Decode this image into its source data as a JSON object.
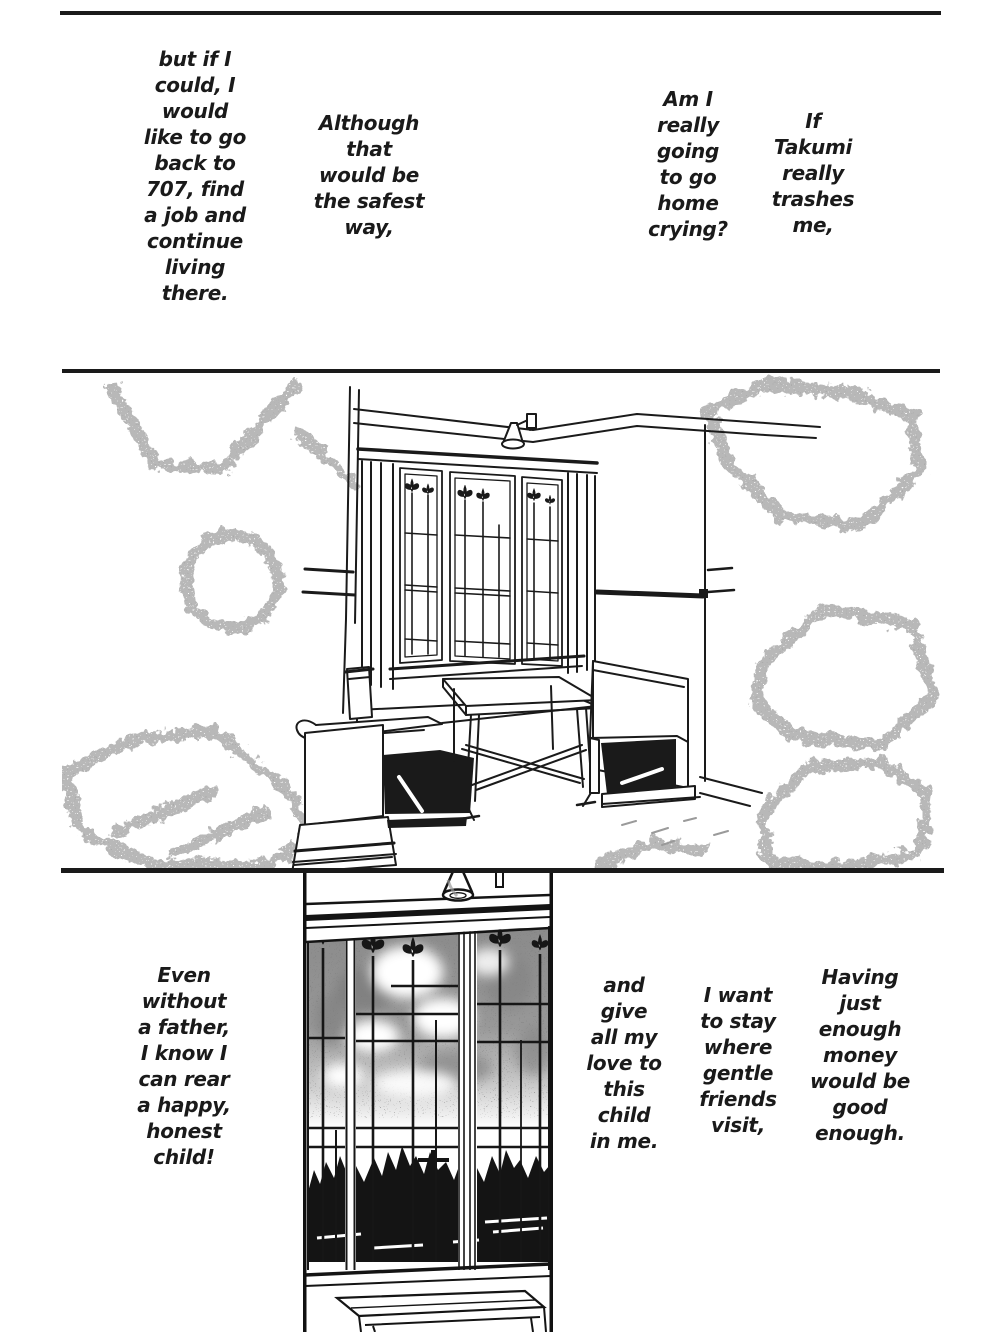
{
  "page": {
    "bg": "#ffffff",
    "ink": "#1a1a1a",
    "tone_gray": "#9a9a9a"
  },
  "thoughts": {
    "t1": {
      "text": "but if I\ncould, I\nwould\nlike to go\nback to\n707, find\na job and\ncontinue\nliving\nthere."
    },
    "t2": {
      "text": "Although\nthat\nwould be\nthe safest\nway,"
    },
    "t3": {
      "text": "Am I\nreally\ngoing\nto go\nhome\ncrying?"
    },
    "t4": {
      "text": "If\nTakumi\nreally\ntrashes\nme,"
    },
    "t5": {
      "text": "Even\nwithout\na father,\nI know I\ncan rear\na happy,\nhonest\nchild!"
    },
    "t6": {
      "text": "and\ngive\nall my\nlove to\nthis\nchild\nin me."
    },
    "t7": {
      "text": "I want\nto stay\nwhere\ngentle\nfriends\nvisit,"
    },
    "t8": {
      "text": "Having\njust\nenough\nmoney\nwould be\ngood\nenough."
    }
  }
}
